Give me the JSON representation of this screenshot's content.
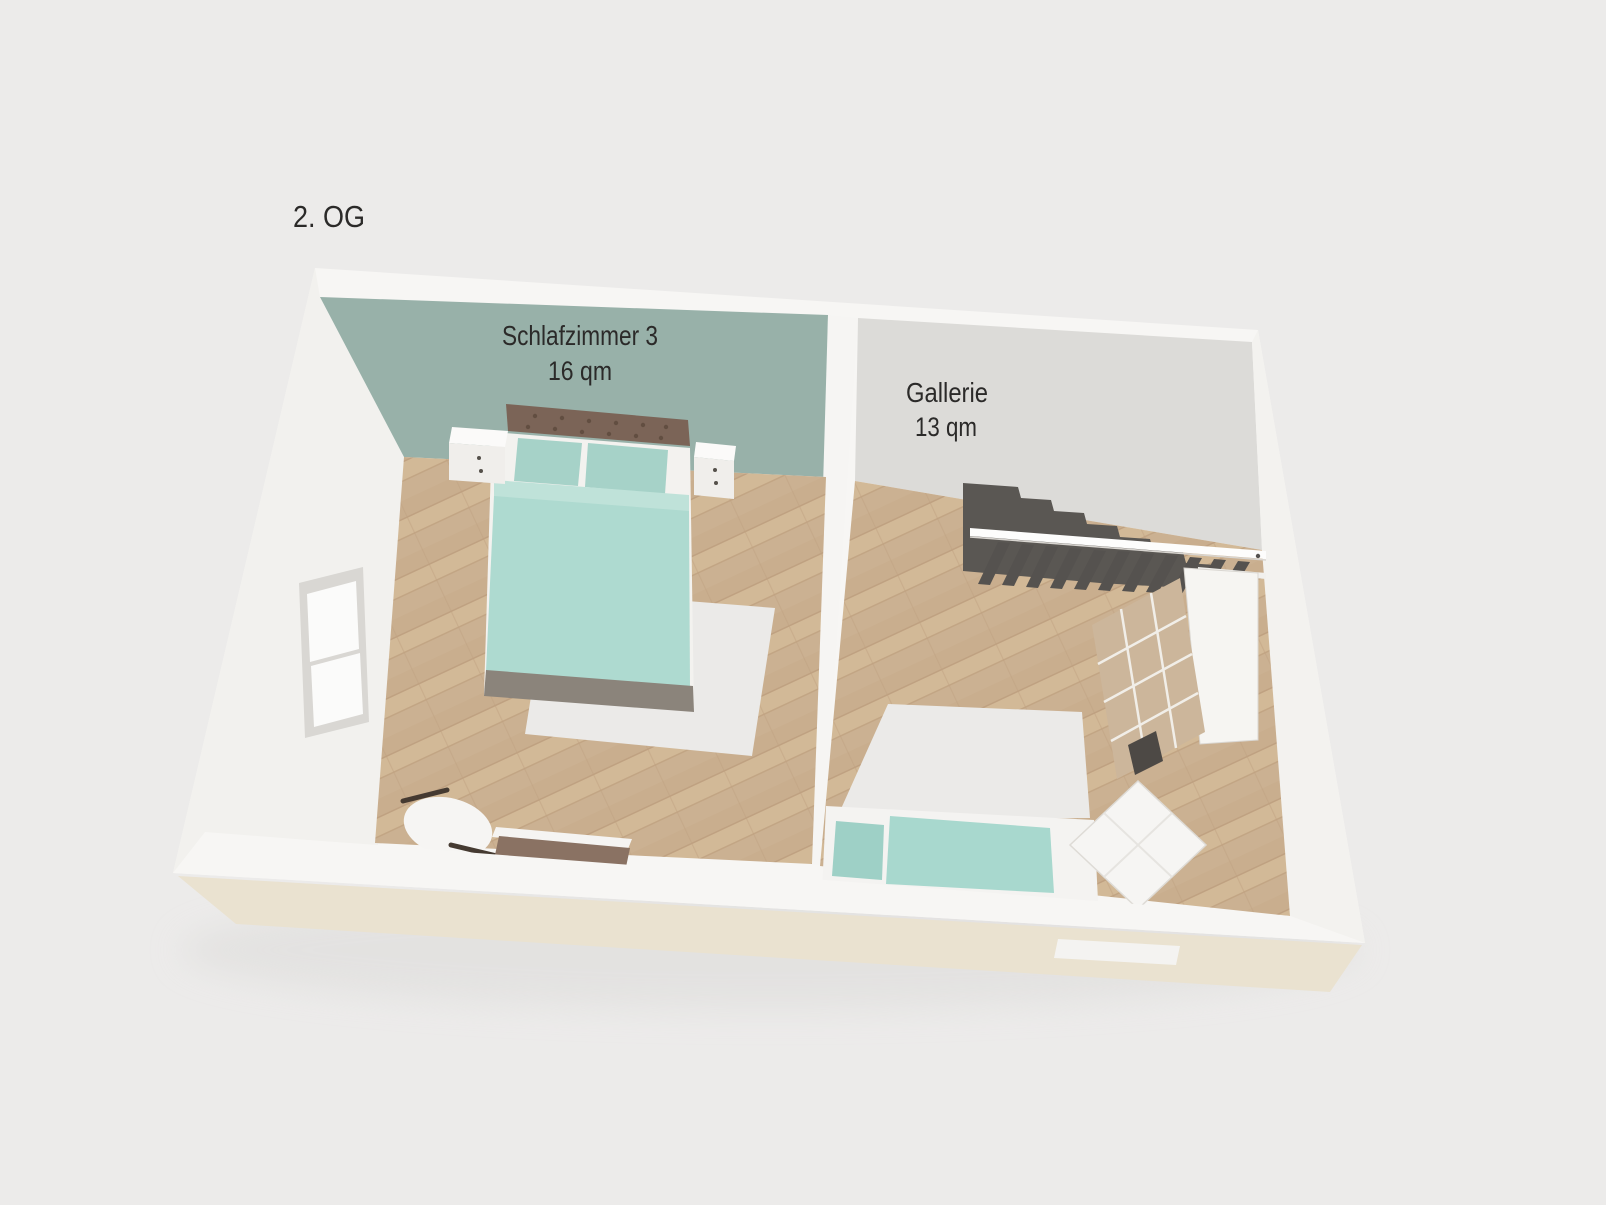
{
  "page": {
    "background_color": "#ecebea"
  },
  "plan": {
    "floor_label": "2. OG",
    "rooms": [
      {
        "name": "Schlafzimmer 3",
        "area": "16 qm",
        "accent_wall_color": "#98b1a9",
        "furniture": [
          "double-bed",
          "tufted-headboard",
          "nightstand-left",
          "nightstand-right",
          "white-rug",
          "armchair",
          "sideboard",
          "window"
        ]
      },
      {
        "name": "Gallerie",
        "area": "13 qm",
        "wall_color": "#dcdbd8",
        "furniture": [
          "staircase",
          "railing-with-balusters",
          "shelf-cabinet",
          "white-rug",
          "daybed-with-teal-cushions",
          "tufted-armchair"
        ]
      }
    ],
    "colors": {
      "wall_white": "#f7f6f4",
      "floor_wood": "#ccb293",
      "slab_edge": "#eae2d0",
      "stairs": "#5a5753",
      "bedding_teal": "#aedad0",
      "pillow_teal": "#a6d2c8",
      "headboard_brown": "#7b6457",
      "cabinet_tan": "#ccb69b",
      "label_text": "#2b2a29"
    }
  }
}
